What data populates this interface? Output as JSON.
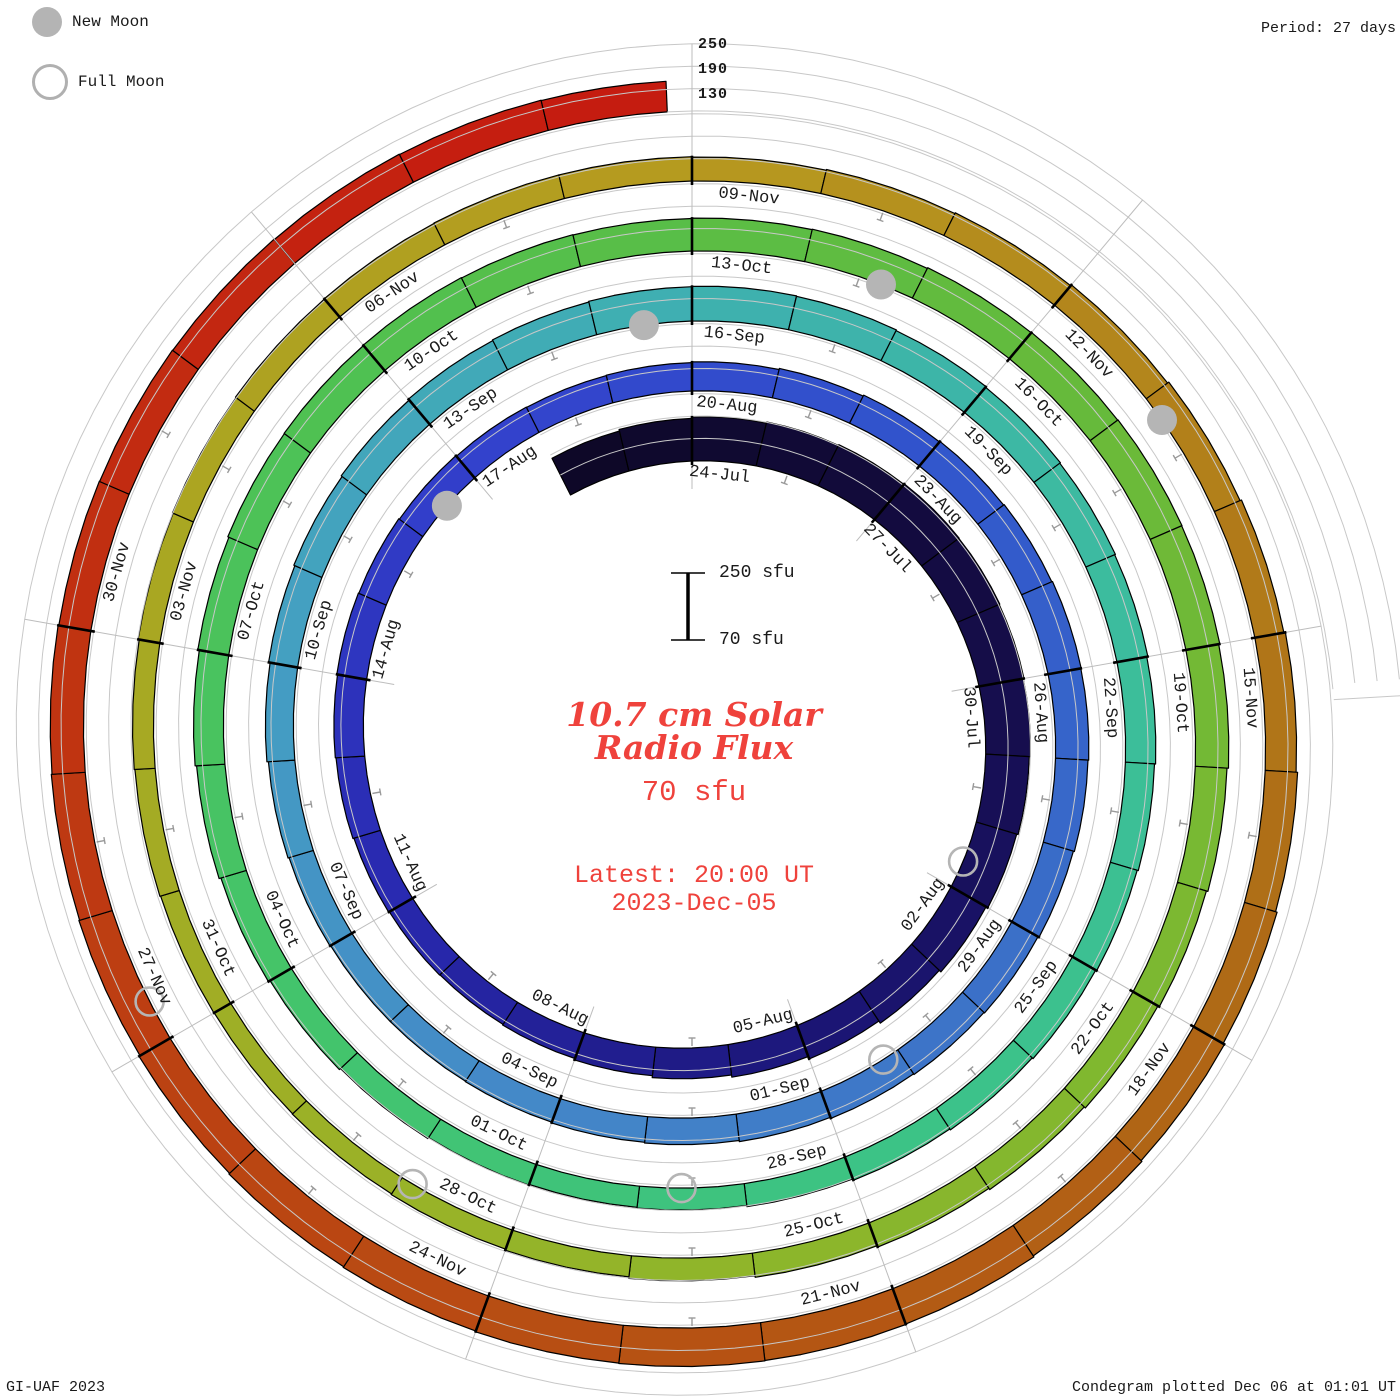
{
  "legend": {
    "new_moon_label": "New Moon",
    "full_moon_label": "Full Moon"
  },
  "period_label": "Period: 27 days",
  "radial_scale_labels": [
    "250",
    "190",
    "130"
  ],
  "scale_bar": {
    "top": "250 sfu",
    "bottom": "70 sfu"
  },
  "center": {
    "title_line1": "10.7 cm Solar",
    "title_line2": "Radio Flux",
    "baseline_label": "70 sfu",
    "latest_line1": "Latest: 20:00 UT",
    "latest_line2": "2023-Dec-05"
  },
  "footer": {
    "left": "GI-UAF 2023",
    "right": "Condegram plotted Dec 06 at 01:01 UT"
  },
  "colors": {
    "background": "#ffffff",
    "red_text": "#ef423c",
    "gridline": "#c8c8c8",
    "spoke": "#bdbdbd",
    "tick_minor": "#9a9a9a",
    "bar_outline": "#000000",
    "moon_gray": "#b5b5b5",
    "label_text": "#1a1a1a",
    "colormap": [
      [
        0,
        "#0d0826"
      ],
      [
        8,
        "#150d4a"
      ],
      [
        14,
        "#1c1678"
      ],
      [
        20,
        "#2828ae"
      ],
      [
        26,
        "#3340cc"
      ],
      [
        32,
        "#3155cc"
      ],
      [
        38,
        "#3a6ec8"
      ],
      [
        44,
        "#4487c8"
      ],
      [
        50,
        "#449ec2"
      ],
      [
        56,
        "#3eb0b0"
      ],
      [
        62,
        "#3cbd9c"
      ],
      [
        68,
        "#3cc384"
      ],
      [
        74,
        "#44c46a"
      ],
      [
        80,
        "#50c150"
      ],
      [
        86,
        "#64ba3c"
      ],
      [
        92,
        "#7eb830"
      ],
      [
        98,
        "#96b428"
      ],
      [
        104,
        "#a8a822"
      ],
      [
        110,
        "#b69a1f"
      ],
      [
        114,
        "#b2831b"
      ],
      [
        118,
        "#ae6c16"
      ],
      [
        123,
        "#b55413"
      ],
      [
        128,
        "#bc4012"
      ],
      [
        132,
        "#c22d11"
      ],
      [
        136,
        "#c51c10"
      ]
    ]
  },
  "chart_data": {
    "type": "spiral-bar-condegram",
    "title": "10.7 cm Solar Radio Flux",
    "units": "sfu",
    "period_days": 27,
    "degrees_per_day": 13.3333,
    "start_date": "2023-Jul-22",
    "end_date": "2023-Dec-05 20:00 UT",
    "end_day_fraction": 136.83,
    "baseline_sfu": 70,
    "radial_gridlines_sfu": [
      130,
      190,
      250
    ],
    "daily_flux_sfu": [
      180,
      184,
      188,
      191,
      193,
      195,
      194,
      192,
      190,
      187,
      183,
      178,
      172,
      165,
      158,
      152,
      147,
      143,
      141,
      142,
      144,
      147,
      149,
      151,
      150,
      148,
      146,
      145,
      146,
      148,
      151,
      154,
      156,
      158,
      160,
      159,
      157,
      154,
      151,
      149,
      147,
      144,
      141,
      139,
      137,
      136,
      136,
      138,
      141,
      145,
      149,
      152,
      155,
      158,
      160,
      162,
      163,
      162,
      160,
      158,
      156,
      154,
      151,
      148,
      145,
      142,
      139,
      136,
      132,
      129,
      127,
      129,
      132,
      136,
      141,
      146,
      150,
      154,
      157,
      158,
      159,
      158,
      157,
      158,
      159,
      161,
      162,
      163,
      162,
      159,
      155,
      151,
      147,
      143,
      139,
      135,
      131,
      127,
      124,
      122,
      121,
      122,
      124,
      126,
      129,
      131,
      133,
      134,
      135,
      135,
      134,
      136,
      138,
      141,
      145,
      149,
      153,
      157,
      161,
      165,
      168,
      171,
      172,
      173,
      172,
      170,
      168,
      166,
      163,
      161,
      159,
      157,
      156,
      155,
      154,
      153,
      152
    ],
    "date_labels": [
      [
        2,
        "24-Jul"
      ],
      [
        5,
        "27-Jul"
      ],
      [
        8,
        "30-Jul"
      ],
      [
        11,
        "02-Aug"
      ],
      [
        14,
        "05-Aug"
      ],
      [
        17,
        "08-Aug"
      ],
      [
        20,
        "11-Aug"
      ],
      [
        23,
        "14-Aug"
      ],
      [
        26,
        "17-Aug"
      ],
      [
        29,
        "20-Aug"
      ],
      [
        32,
        "23-Aug"
      ],
      [
        35,
        "26-Aug"
      ],
      [
        38,
        "29-Aug"
      ],
      [
        41,
        "01-Sep"
      ],
      [
        44,
        "04-Sep"
      ],
      [
        47,
        "07-Sep"
      ],
      [
        50,
        "10-Sep"
      ],
      [
        53,
        "13-Sep"
      ],
      [
        56,
        "16-Sep"
      ],
      [
        59,
        "19-Sep"
      ],
      [
        62,
        "22-Sep"
      ],
      [
        65,
        "25-Sep"
      ],
      [
        68,
        "28-Sep"
      ],
      [
        71,
        "01-Oct"
      ],
      [
        74,
        "04-Oct"
      ],
      [
        77,
        "07-Oct"
      ],
      [
        80,
        "10-Oct"
      ],
      [
        83,
        "13-Oct"
      ],
      [
        86,
        "16-Oct"
      ],
      [
        89,
        "19-Oct"
      ],
      [
        92,
        "22-Oct"
      ],
      [
        95,
        "25-Oct"
      ],
      [
        98,
        "28-Oct"
      ],
      [
        101,
        "31-Oct"
      ],
      [
        104,
        "03-Nov"
      ],
      [
        107,
        "06-Nov"
      ],
      [
        110,
        "09-Nov"
      ],
      [
        113,
        "12-Nov"
      ],
      [
        116,
        "15-Nov"
      ],
      [
        119,
        "18-Nov"
      ],
      [
        122,
        "21-Nov"
      ],
      [
        125,
        "24-Nov"
      ],
      [
        128,
        "27-Nov"
      ],
      [
        131,
        "30-Nov"
      ]
    ],
    "moons": {
      "new": [
        [
          25.5,
          "16-Aug"
        ],
        [
          55.5,
          "15-Sep"
        ],
        [
          84.7,
          "14-Oct"
        ],
        [
          114.2,
          "13-Nov"
        ]
      ],
      "full": [
        [
          10.6,
          "01-Aug"
        ],
        [
          40.2,
          "31-Aug"
        ],
        [
          69.6,
          "29-Sep"
        ],
        [
          98.9,
          "28-Oct"
        ],
        [
          128.3,
          "27-Nov"
        ]
      ]
    }
  }
}
